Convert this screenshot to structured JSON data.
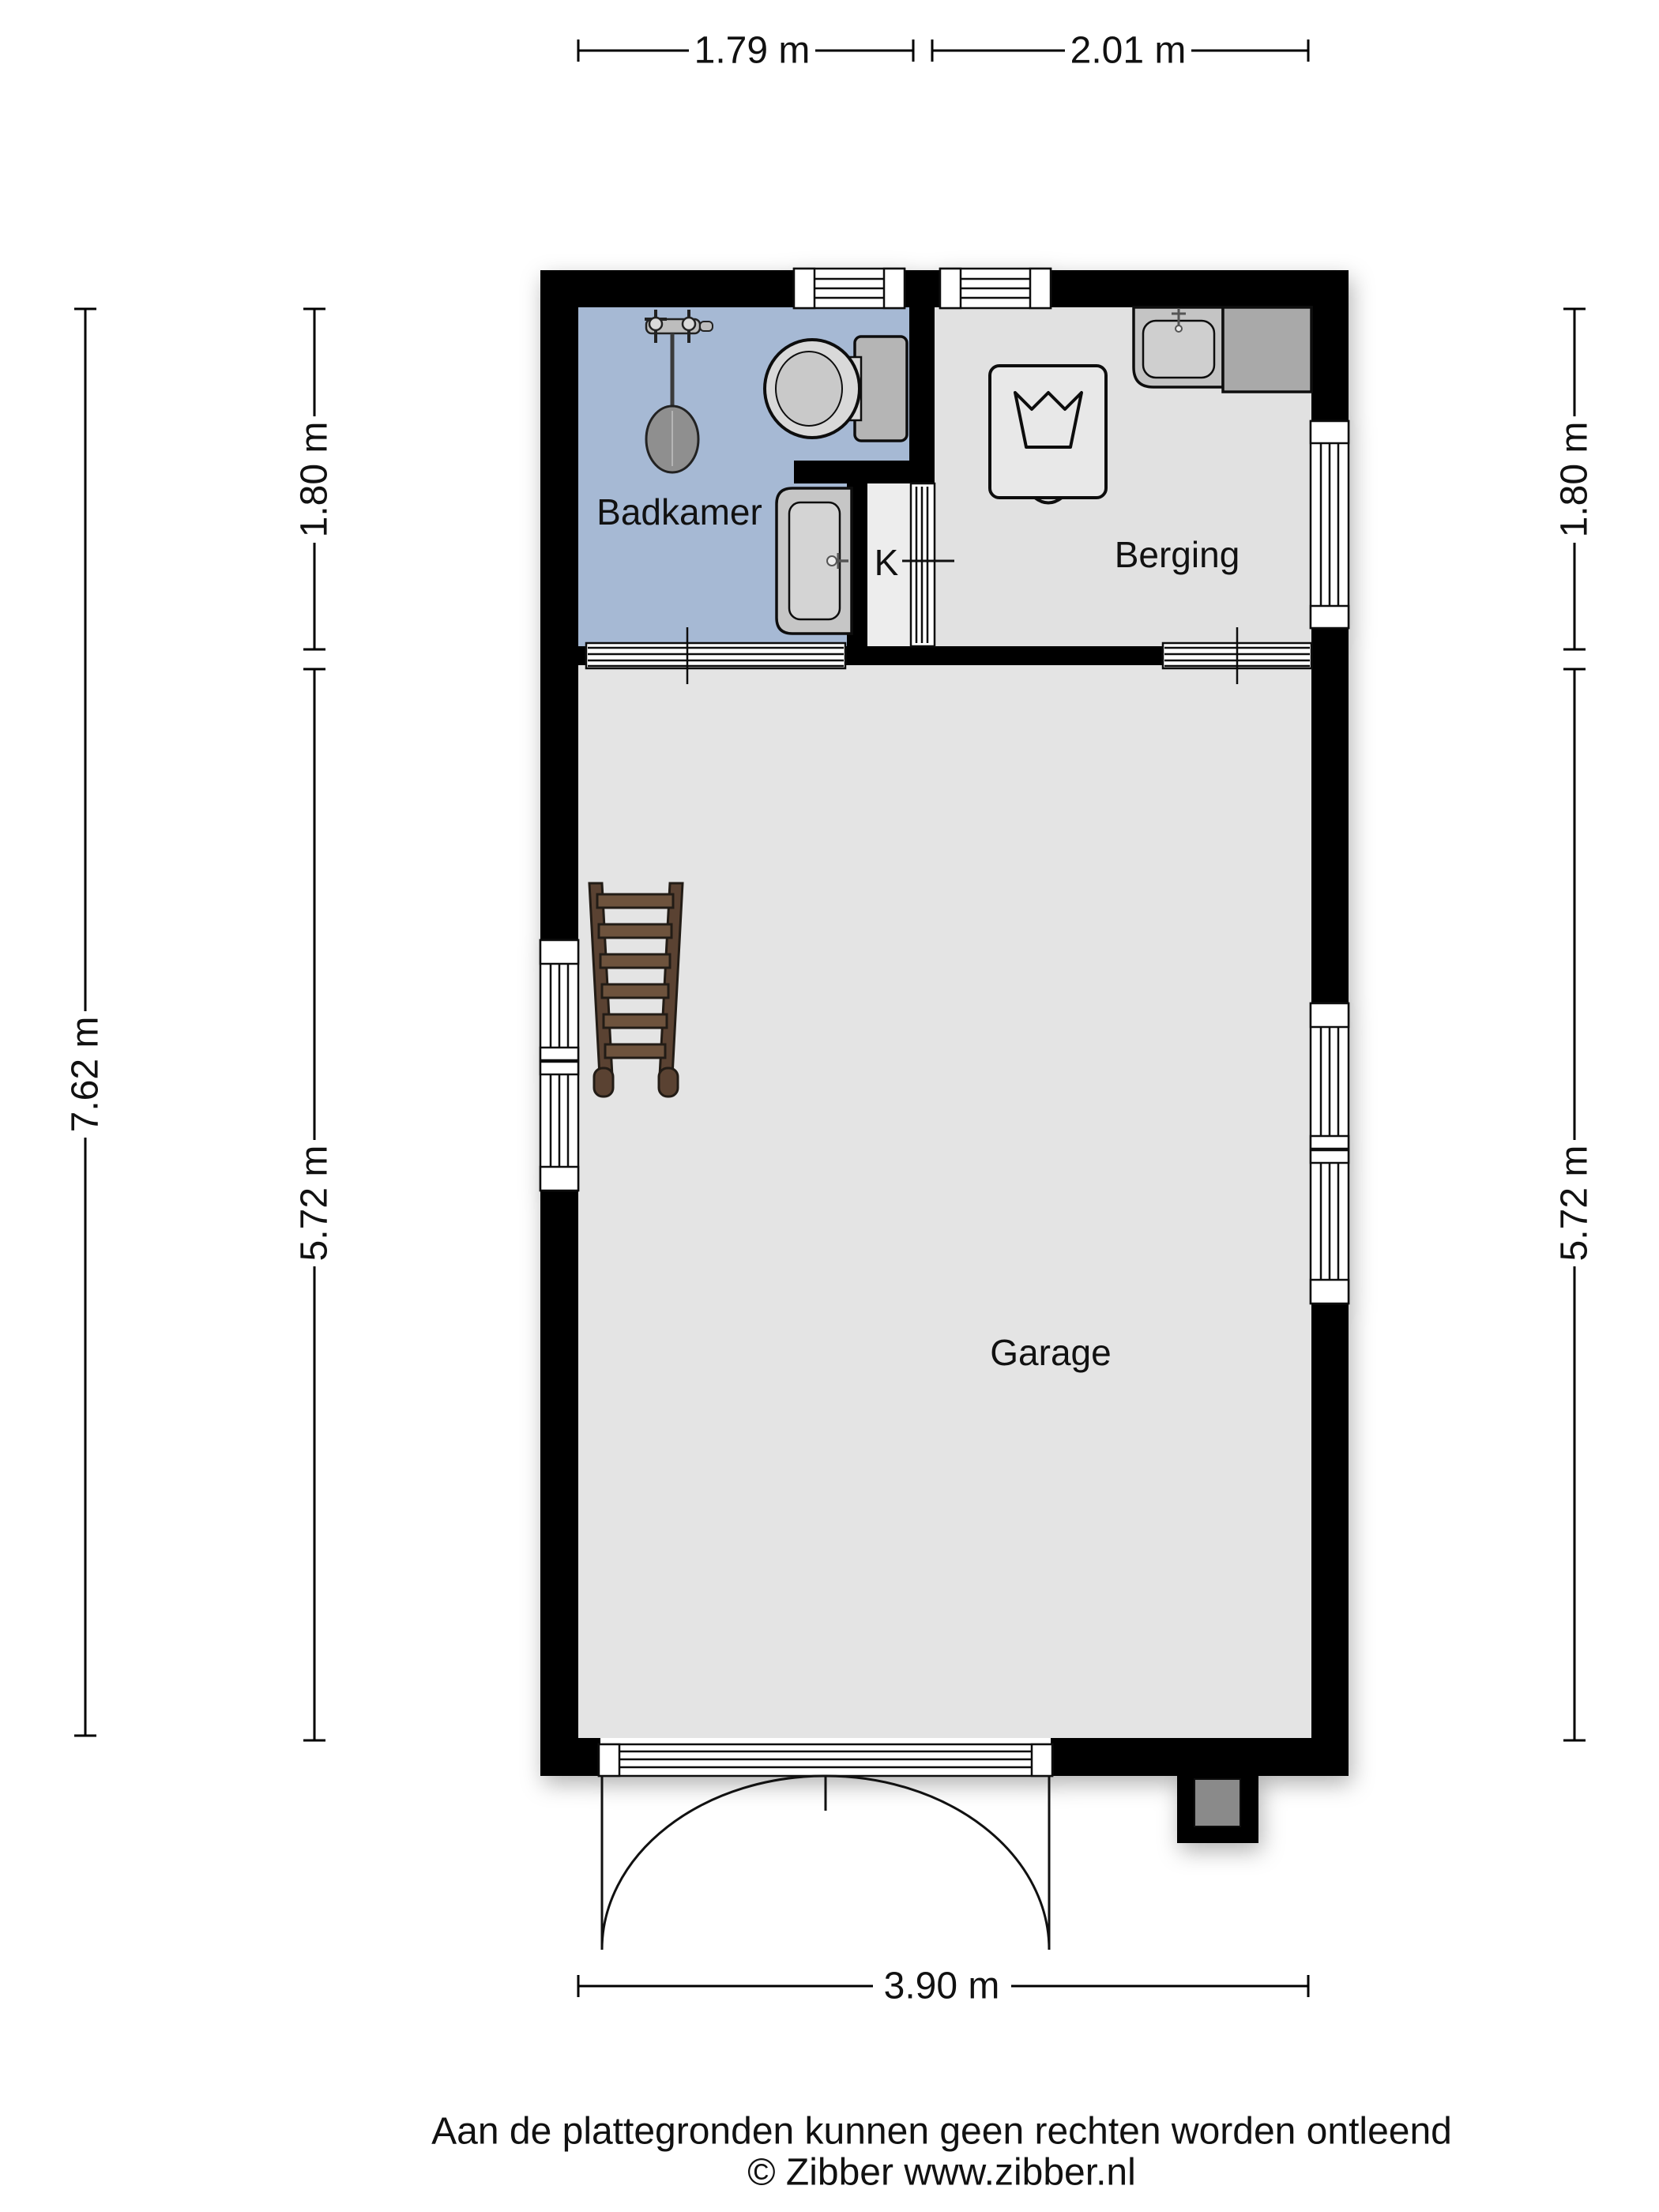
{
  "plan": {
    "type": "floor-plan",
    "rooms": [
      {
        "name": "Badkamer",
        "floor_color": "#a6b9d4"
      },
      {
        "name": "K",
        "floor_color": "#ededed"
      },
      {
        "name": "Berging",
        "floor_color": "#e1e1e1"
      },
      {
        "name": "Garage",
        "floor_color": "#e4e4e4"
      }
    ],
    "fixtures": [
      "shower",
      "toilet",
      "washbasin",
      "washing-machine",
      "kitchen-sink",
      "counter",
      "ladder"
    ],
    "colors": {
      "wall": "#000000",
      "background": "#ffffff",
      "bathroom_blue": "#a6b9d4",
      "floor_gray": "#e3e3e3",
      "ladder_wood": "#6e523c"
    }
  },
  "dimensions": {
    "top": [
      "1.79 m",
      "2.01 m"
    ],
    "left_outer": "7.62 m",
    "left_inner": [
      "1.80 m",
      "5.72 m"
    ],
    "right": [
      "1.80 m",
      "5.72 m"
    ],
    "bottom": "3.90 m"
  },
  "footer": {
    "disclaimer": "Aan de plattegronden kunnen geen rechten worden ontleend",
    "credit": "© Zibber www.zibber.nl"
  }
}
